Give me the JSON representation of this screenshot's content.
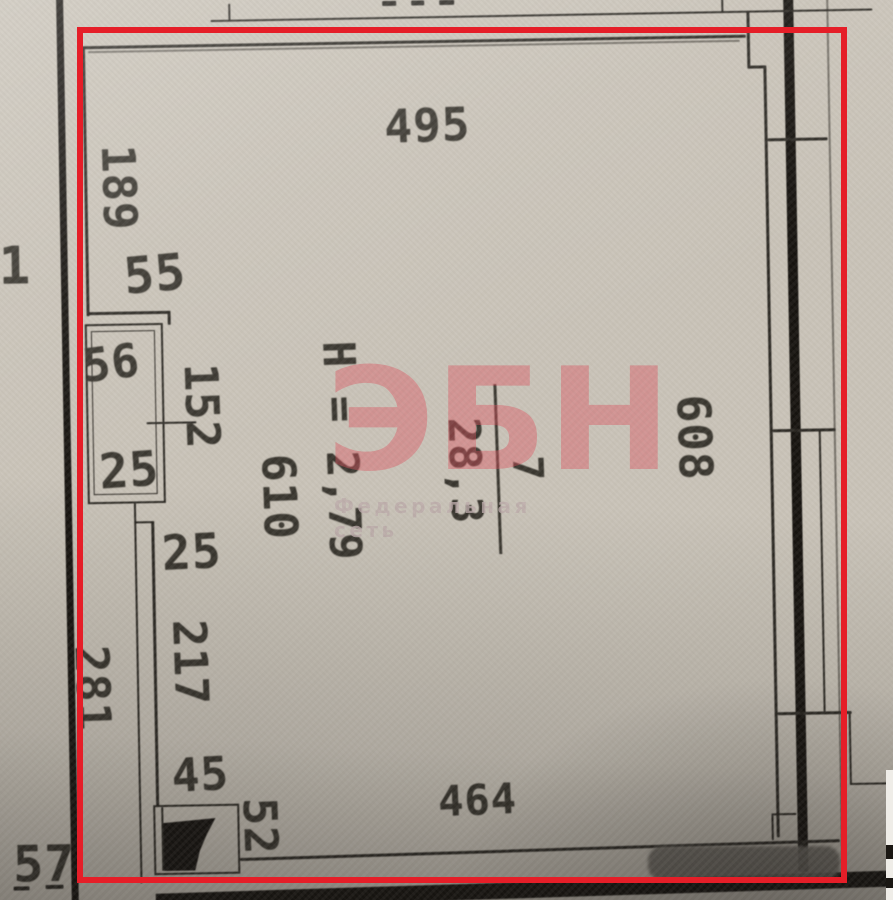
{
  "annotation": {
    "highlight_color": "#e51e28"
  },
  "watermark": {
    "logo": "ЭБН",
    "caption": "Федеральная сеть"
  },
  "room": {
    "number": "7",
    "area": "28,3",
    "ceiling_height": "H = 2,79"
  },
  "dims": {
    "top": "495",
    "bottom": "464",
    "right": "608",
    "left": "189",
    "step": "55",
    "niche_w": "56",
    "niche_d": "152",
    "under_niche": "25",
    "inner_left": "610",
    "step2": "25",
    "lower_left": "217",
    "outer_left": "281",
    "door_offset": "45",
    "door_w": "52",
    "outside_bottom": "57",
    "adjacent": "1"
  }
}
